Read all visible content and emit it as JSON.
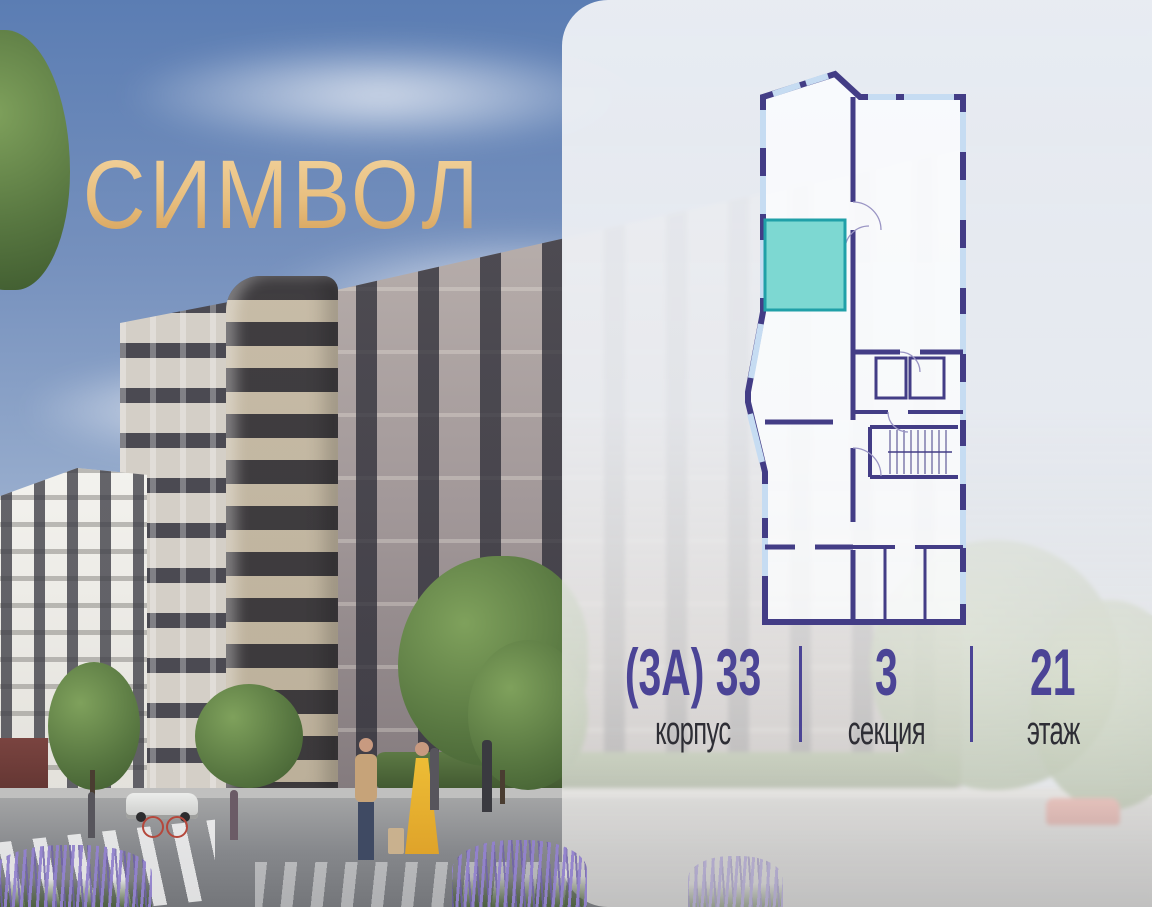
{
  "branding": {
    "logo_text": "СИМВОЛ"
  },
  "colors": {
    "logo_gold_light": "#f2d39e",
    "logo_gold_dark": "#d5a058",
    "accent_purple": "#4b4496",
    "plan_wall_purple": "#433d86",
    "plan_window_blue": "#c6dcf2",
    "highlight_teal_fill": "#7dd8d2",
    "highlight_teal_border": "#20a0a8",
    "label_dark": "#2e2e35"
  },
  "apartment_info": {
    "building": {
      "value": "(3А) 33",
      "label": "корпус"
    },
    "section": {
      "value": "3",
      "label": "секция"
    },
    "floor": {
      "value": "21",
      "label": "этаж"
    }
  },
  "floorplan": {
    "kind": "residential-floor-plan",
    "highlighted_unit_color": "#7dd8d2"
  }
}
